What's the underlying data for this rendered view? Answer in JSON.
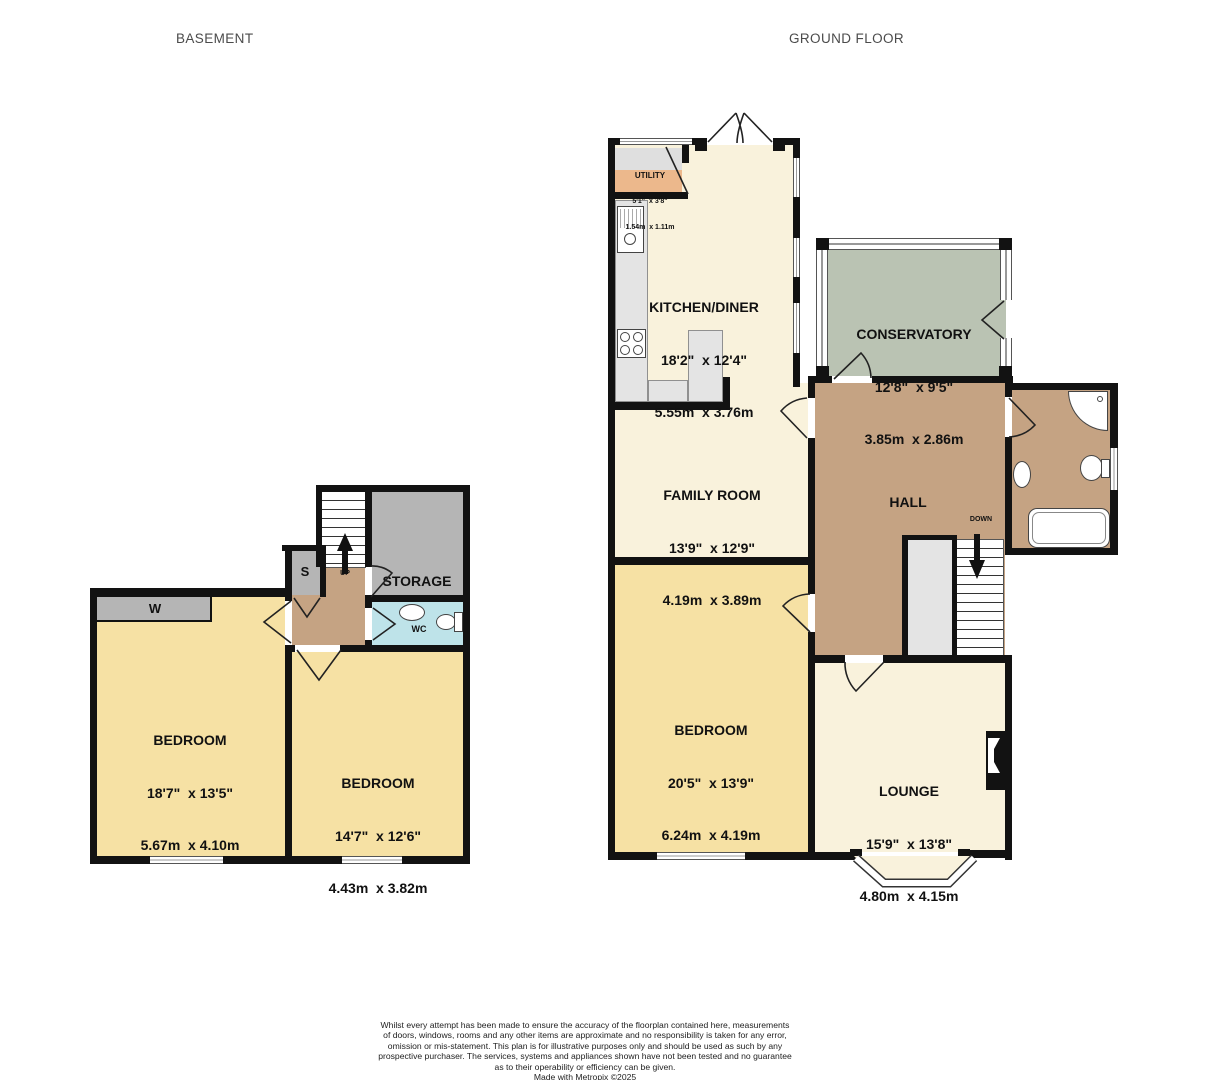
{
  "floors": {
    "basement": {
      "title": "BASEMENT",
      "rooms": {
        "bedroom1": {
          "name": "BEDROOM",
          "imperial": "18'7\"  x 13'5\"",
          "metric": "5.67m  x 4.10m"
        },
        "bedroom2": {
          "name": "BEDROOM",
          "imperial": "14'7\"  x 12'6\"",
          "metric": "4.43m  x 3.82m"
        },
        "storage": {
          "name": "STORAGE"
        },
        "wardrobe": {
          "label": "W"
        },
        "cupboard": {
          "label": "S"
        },
        "wc": {
          "label": "WC"
        },
        "stairs": {
          "label": "UP"
        }
      }
    },
    "ground": {
      "title": "GROUND FLOOR",
      "rooms": {
        "utility": {
          "name": "UTILITY",
          "imperial": "5'1\"  x 3'8\"",
          "metric": "1.54m  x 1.11m"
        },
        "kitchen": {
          "name": "KITCHEN/DINER",
          "imperial": "18'2\"  x 12'4\"",
          "metric": "5.55m  x 3.76m"
        },
        "conservatory": {
          "name": "CONSERVATORY",
          "imperial": "12'8\"  x 9'5\"",
          "metric": "3.85m  x 2.86m"
        },
        "family": {
          "name": "FAMILY ROOM",
          "imperial": "13'9\"  x 12'9\"",
          "metric": "4.19m  x 3.89m"
        },
        "hall": {
          "name": "HALL"
        },
        "bedroom": {
          "name": "BEDROOM",
          "imperial": "20'5\"  x 13'9\"",
          "metric": "6.24m  x 4.19m"
        },
        "lounge": {
          "name": "LOUNGE",
          "imperial": "15'9\"  x 13'8\"",
          "metric": "4.80m  x 4.15m"
        },
        "stairs": {
          "label": "DOWN"
        }
      }
    }
  },
  "disclaimer": {
    "lines": [
      "Whilst every attempt has been made to ensure the accuracy of the floorplan contained here, measurements",
      "of doors, windows, rooms and any other items are approximate and no responsibility is taken for any error,",
      "omission or mis-statement. This plan is for illustrative purposes only and should be used as such by any",
      "prospective purchaser. The services, systems and appliances shown have not been tested and no guarantee",
      "as to their operability or efficiency can be given."
    ],
    "credit": "Made with Metropix ©2025"
  },
  "colors": {
    "wall": "#121212",
    "bedroom": "#f6e1a4",
    "living": "#f9f2dc",
    "hall": "#c5a383",
    "conservatory": "#bac3b3",
    "wc": "#bee3e9",
    "storage": "#b5b5b5",
    "counter": "#e4e4e4",
    "utility": "#ecb88c"
  }
}
